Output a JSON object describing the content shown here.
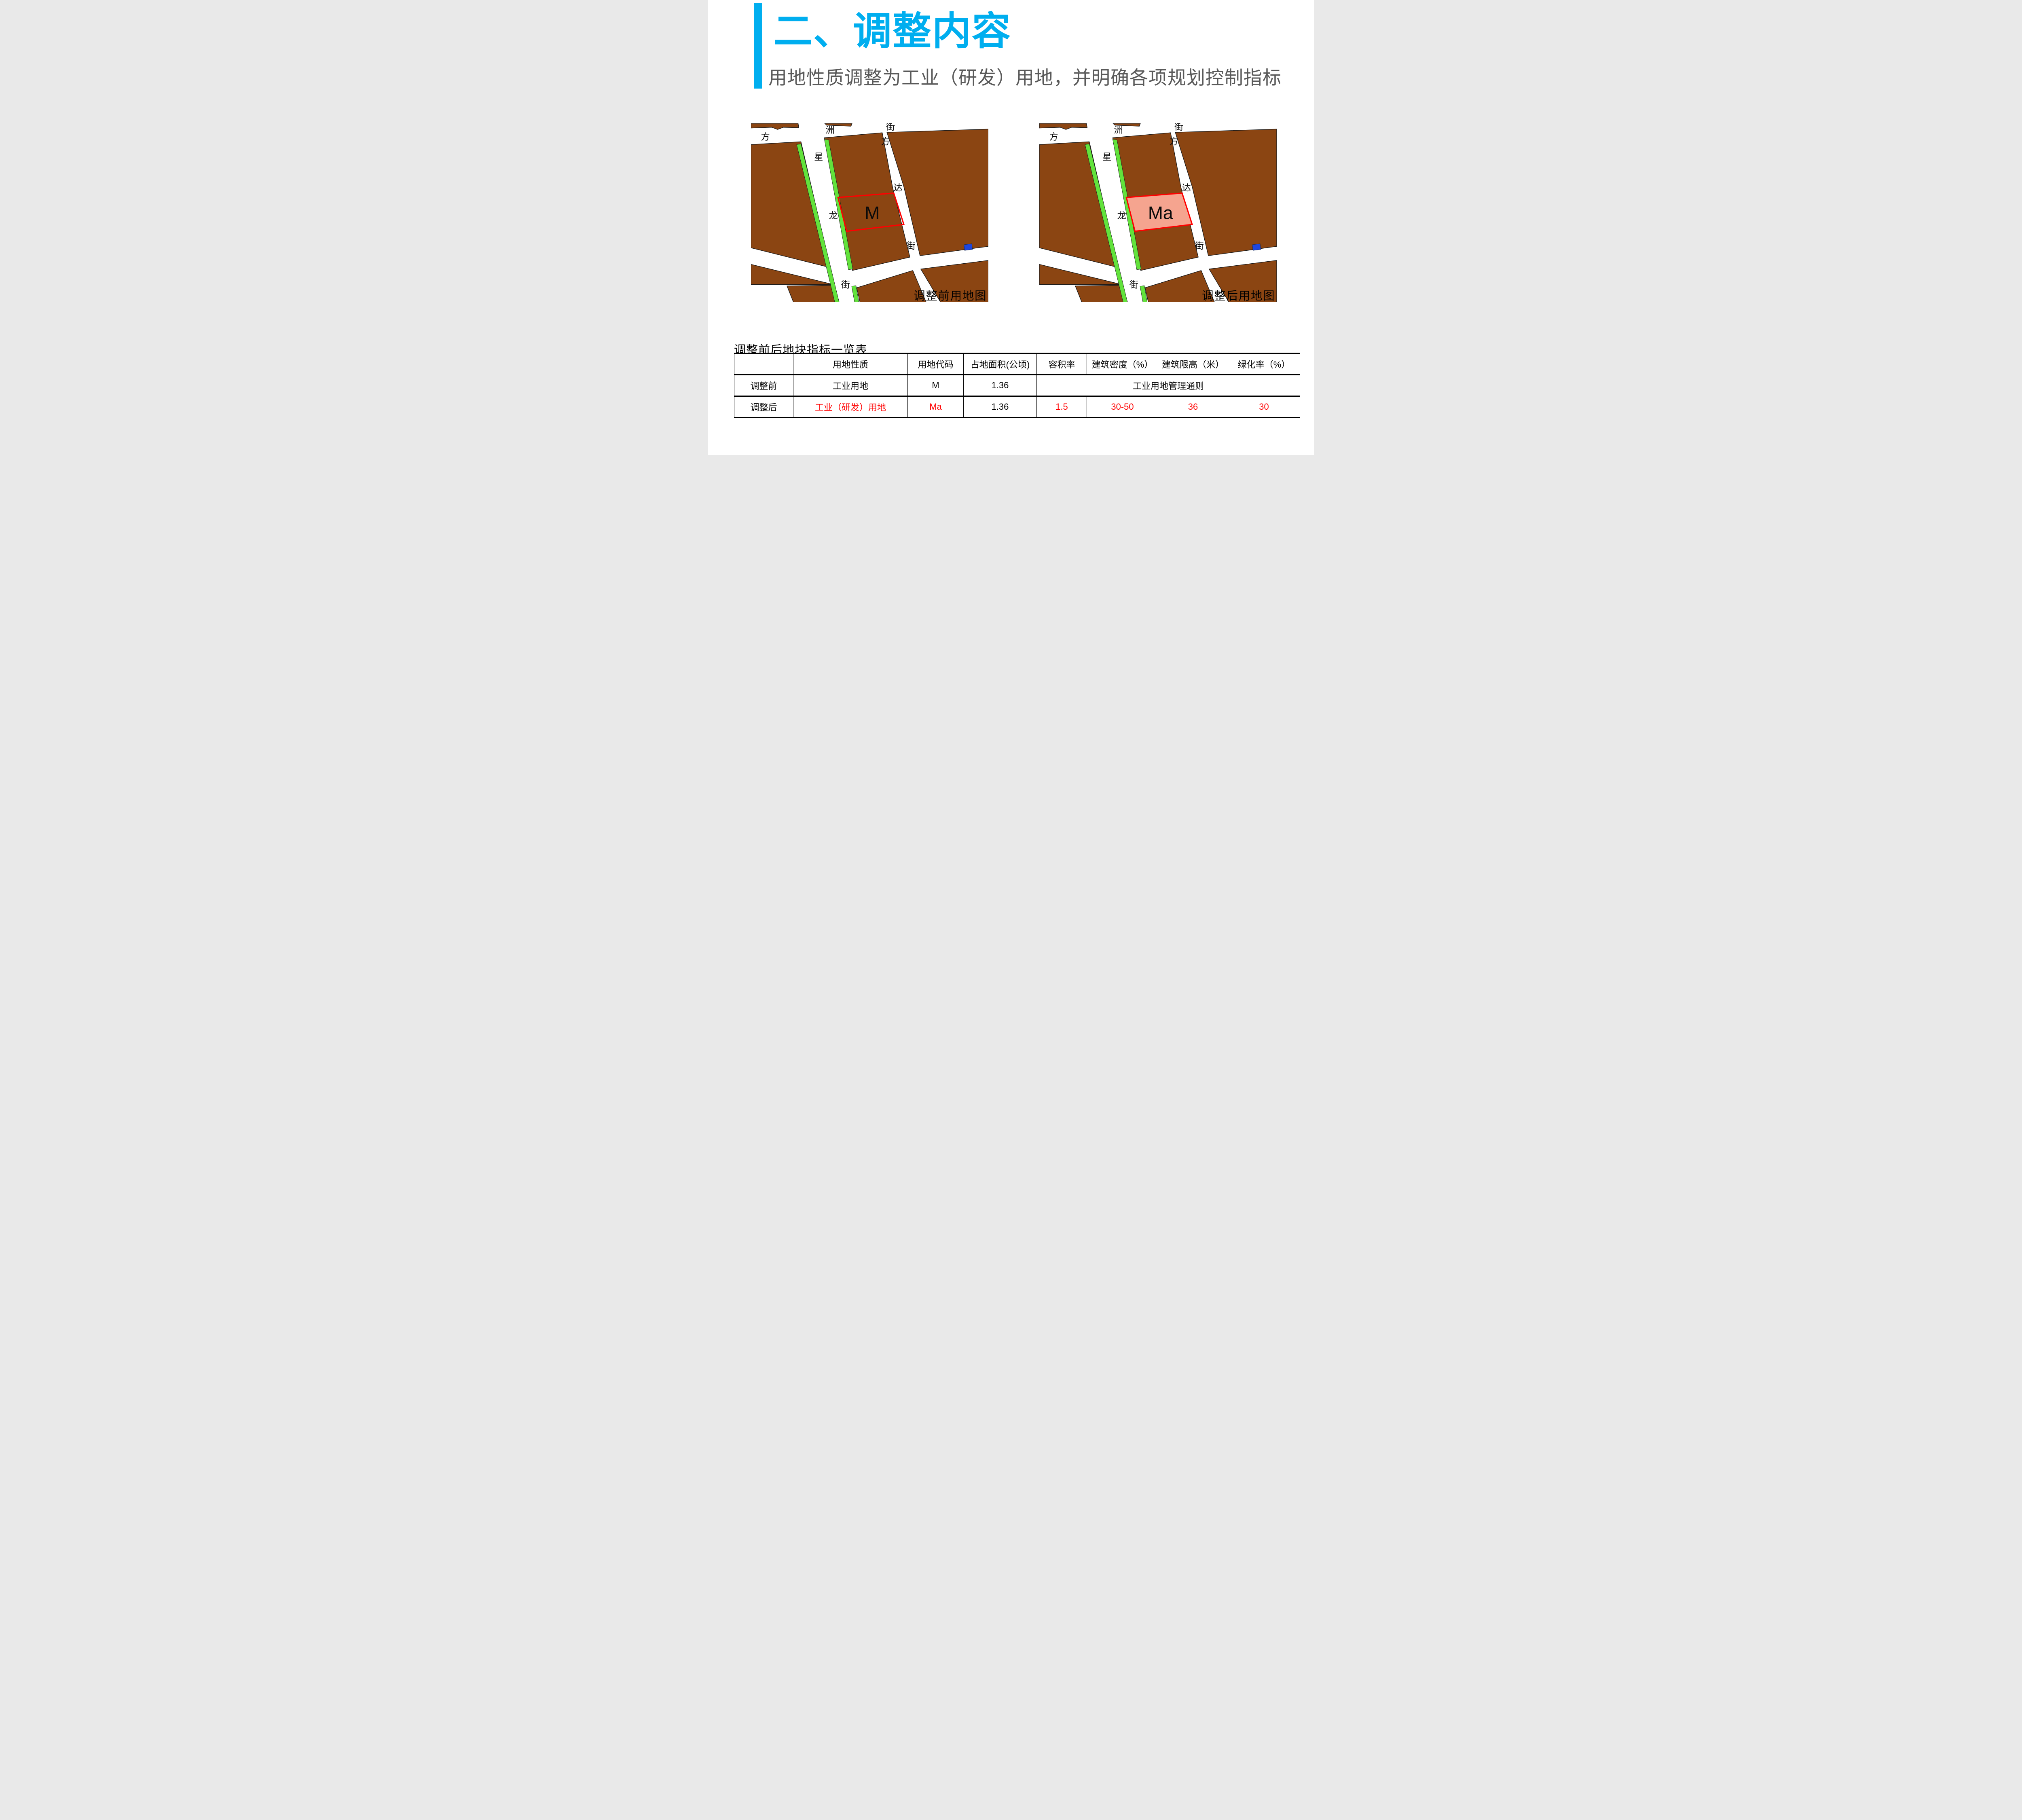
{
  "slide": {
    "title": "二、调整内容",
    "subtitle": "用地性质调整为工业（研发）用地，并明确各项规划控制指标"
  },
  "maps": {
    "street_labels": [
      "方",
      "洲",
      "街",
      "方",
      "星",
      "达",
      "龙",
      "街",
      "街"
    ],
    "before": {
      "caption": "调整前用地图",
      "parcel_label": "M",
      "parcel_fill": "none"
    },
    "after": {
      "caption": "调整后用地图",
      "parcel_label": "Ma",
      "parcel_fill": "#F5A48F"
    }
  },
  "table": {
    "title": "调整前后地块指标一览表",
    "headers": [
      "",
      "用地性质",
      "用地代码",
      "占地面积(公顷)",
      "容积率",
      "建筑密度（%）",
      "建筑限高（米）",
      "绿化率（%）"
    ],
    "row_before": {
      "label": "调整前",
      "nature": "工业用地",
      "code": "M",
      "area": "1.36",
      "merged": "工业用地管理通则"
    },
    "row_after": {
      "label": "调整后",
      "nature": "工业（研发）用地",
      "code": "Ma",
      "area": "1.36",
      "far": "1.5",
      "density": "30-50",
      "height": "36",
      "green": "30"
    }
  },
  "colors": {
    "accent_blue": "#00AEEF",
    "subtitle_gray": "#595959",
    "land_brown": "#8B4512",
    "greenbelt_green": "#62E23C",
    "parcel_outline_red": "#FF0000",
    "parcel_fill_pink": "#F5A48F",
    "water_blue": "#1E46DE",
    "table_highlight_red": "#FF0000"
  }
}
